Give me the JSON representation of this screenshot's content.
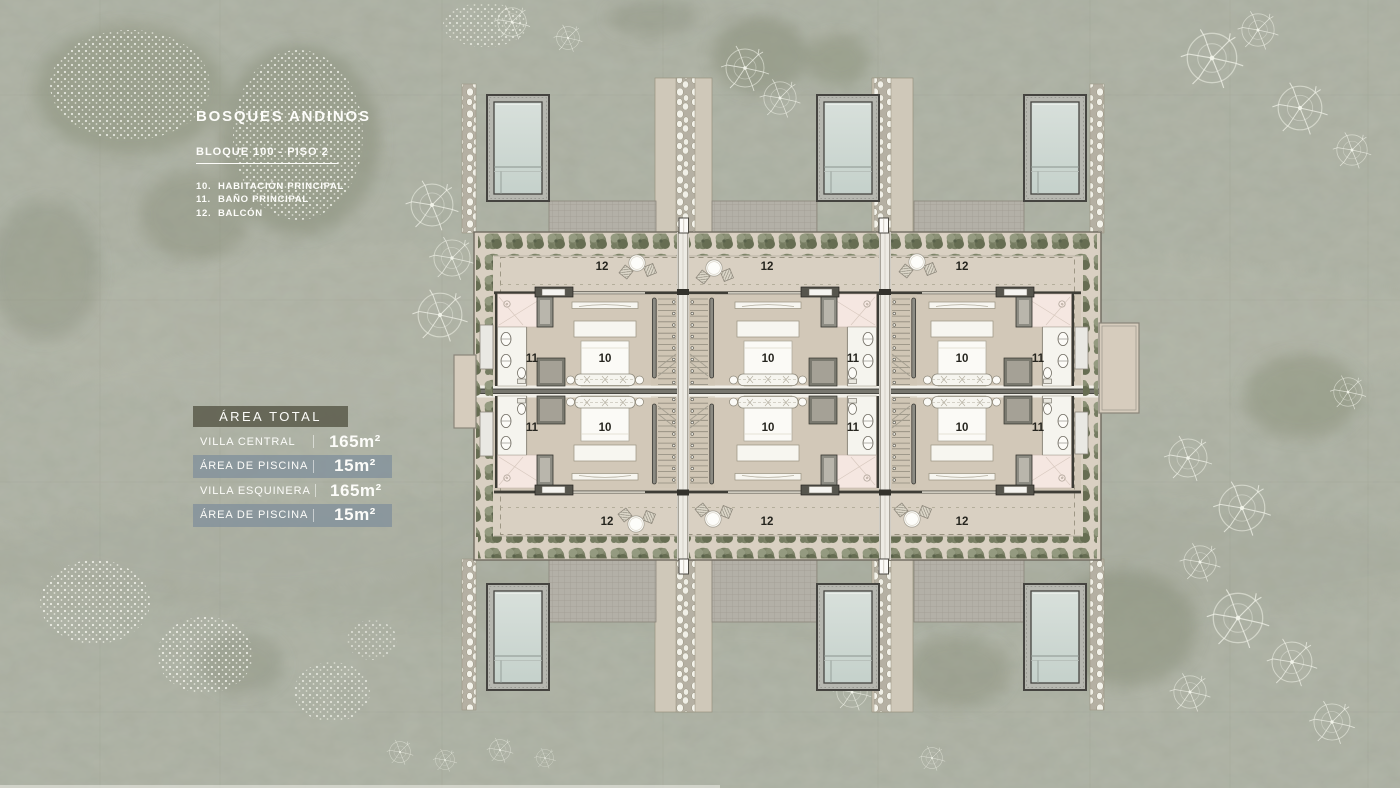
{
  "title_block": {
    "project_title": "BOSQUES ANDINOS",
    "block_label": "BLOQUE 100 - PISO 2",
    "legend": [
      {
        "num": "10.",
        "label": "HABITACIÓN PRINCIPAL"
      },
      {
        "num": "11.",
        "label": "BAÑO PRINCIPAL"
      },
      {
        "num": "12.",
        "label": "BALCÓN"
      }
    ]
  },
  "area_table": {
    "header": "ÁREA TOTAL",
    "rows": [
      {
        "label": "VILLA CENTRAL",
        "value": "165m²"
      },
      {
        "label": "ÁREA DE PISCINA",
        "value": "15m²"
      },
      {
        "label": "VILLA ESQUINERA",
        "value": "165m²"
      },
      {
        "label": "ÁREA DE PISCINA",
        "value": "15m²"
      }
    ]
  },
  "plan": {
    "room_labels": {
      "bedroom": "10",
      "bathroom": "11",
      "balcony": "12"
    }
  },
  "colors": {
    "land": "#a9ad9f",
    "floor_beige": "#d9d0c2",
    "water": "#cdd8d3",
    "header_band": "#5f5f50",
    "highlight_band": "#85939c",
    "text_light": "#fcfcf9"
  }
}
